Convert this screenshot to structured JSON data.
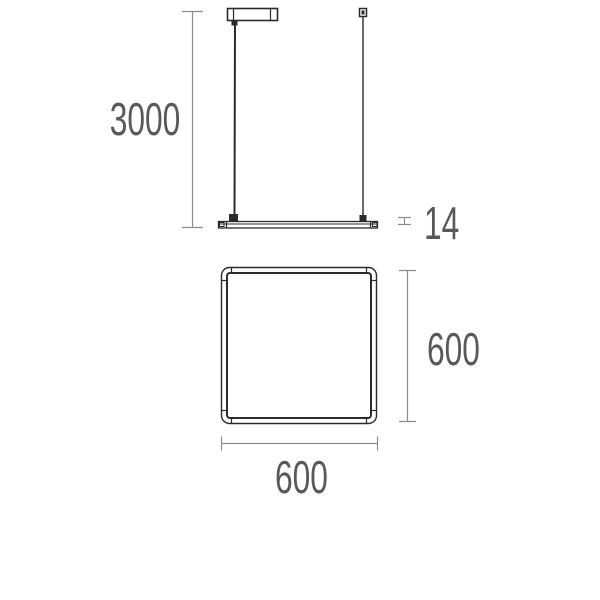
{
  "page": {
    "background": "#ffffff"
  },
  "drawing": {
    "type": "technical-dimension-drawing",
    "subject": "square-pendant-luminaire",
    "colors": {
      "outline": "#2b2b2b",
      "dimension_line": "#8c8c8c",
      "label_text": "#595959"
    },
    "side_view": {
      "suspension_length_label": "3000",
      "profile_thickness_label": "14"
    },
    "plan_view": {
      "height_label": "600",
      "width_label": "600"
    }
  }
}
